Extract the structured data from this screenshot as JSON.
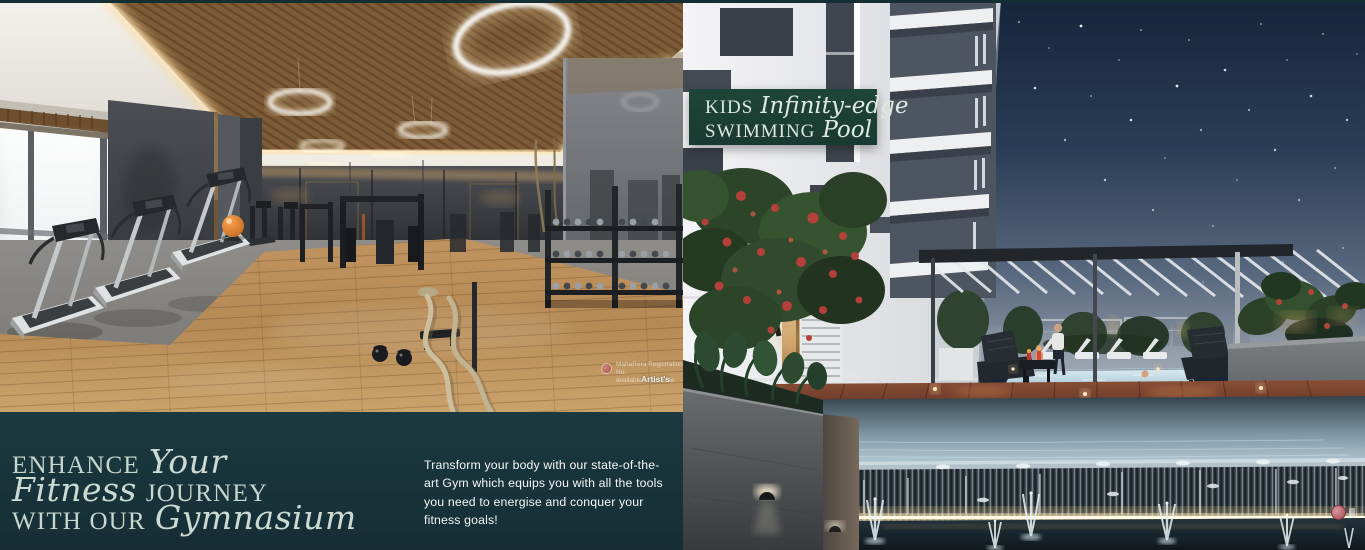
{
  "header_strip": {
    "color": "#142e33"
  },
  "gym_panel": {
    "scene": "gymnasium interior render",
    "watermark": {
      "line1": "MahaRera Registration No.",
      "line2": "available on website",
      "artist_note": "Artist's"
    },
    "banner": {
      "bg_color": "#18343b",
      "heading_line1_serif": "ENHANCE",
      "heading_line1_script": "Your",
      "heading_line2_script": "Fitness",
      "heading_line2_serif": "JOURNEY",
      "heading_line3_serif": "WITH OUR",
      "heading_line3_script": "Gymnasium",
      "description": "Transform your body with our state-of-the-art Gym which equips you with all the tools you need to energise and conquer your fitness goals!"
    }
  },
  "pool_panel": {
    "scene": "kids infinity-edge swimming pool render at dusk",
    "badge": {
      "bg_color": "#1d4238",
      "line1_serif": "KIDS",
      "line1_script": "Infinity-edge",
      "line2_serif": "SWIMMING",
      "line2_script": "Pool"
    }
  },
  "colors": {
    "banner_green": "#18343b",
    "badge_green": "#1d4238",
    "heading_text": "#c6d7cf",
    "description_text": "#f5f7f6",
    "cove_light": "#ffd795",
    "pool_glow": "#cfe6ee"
  }
}
